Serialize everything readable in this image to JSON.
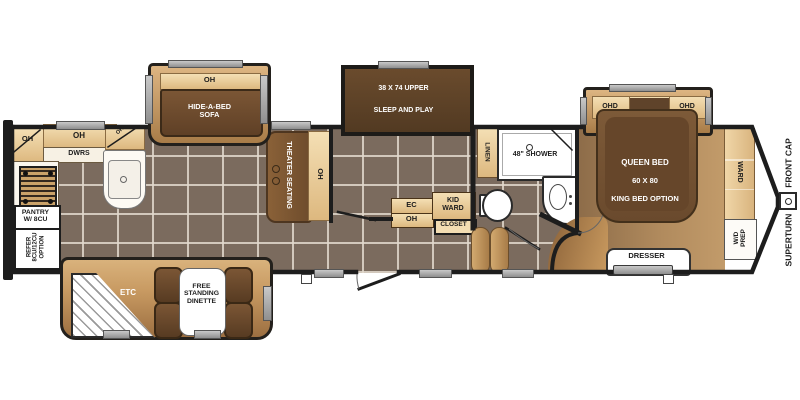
{
  "palette": {
    "wall": "#1d1d1d",
    "tan_cabinet": "#ecd0a2",
    "wood_trim": "#a87c48",
    "dark_brown": "#5c4229",
    "floor_tile": "#7b6b5e",
    "grout": "#e1d8cd",
    "carpet": "#b08a5d",
    "fixture_white": "#ffffff",
    "rail_gray": "#9a9a9a"
  },
  "labels": {
    "kitchen_corner_oh": "OH",
    "kitchen_upper_oh": "OH",
    "kitchen_drawers": "DWRS",
    "kitchen_corner_oh_small": "OH",
    "pantry": "PANTRY\nW/ 8CU",
    "refer": "REFER\n8CU/12CU\nOPTION",
    "sofa_oh": "OH",
    "sofa": "HIDE-A-BED\nSOFA",
    "theater": "THEATER SEATING",
    "theater_oh": "OH",
    "bunk_upper": "38 X 74 UPPER",
    "bunk_lower": "SLEEP AND PLAY",
    "ec": "EC",
    "ec_oh": "OH",
    "kid_ward": "KID\nWARD",
    "closet": "CLOSET",
    "linen": "LINEN",
    "shower": "48\" SHOWER",
    "etc": "ETC",
    "dinette": "FREE\nSTANDING\nDINETTE",
    "ohd_left": "OHD",
    "ohd_right": "OHD",
    "bed_1": "QUEEN BED",
    "bed_2": "60 X 80",
    "bed_3": "KING BED OPTION",
    "ward": "WARD",
    "wd_prep": "W/D\nPREP",
    "dresser": "DRESSER",
    "front_cap": "FRONT CAP",
    "superturn": "SUPERTURN"
  }
}
